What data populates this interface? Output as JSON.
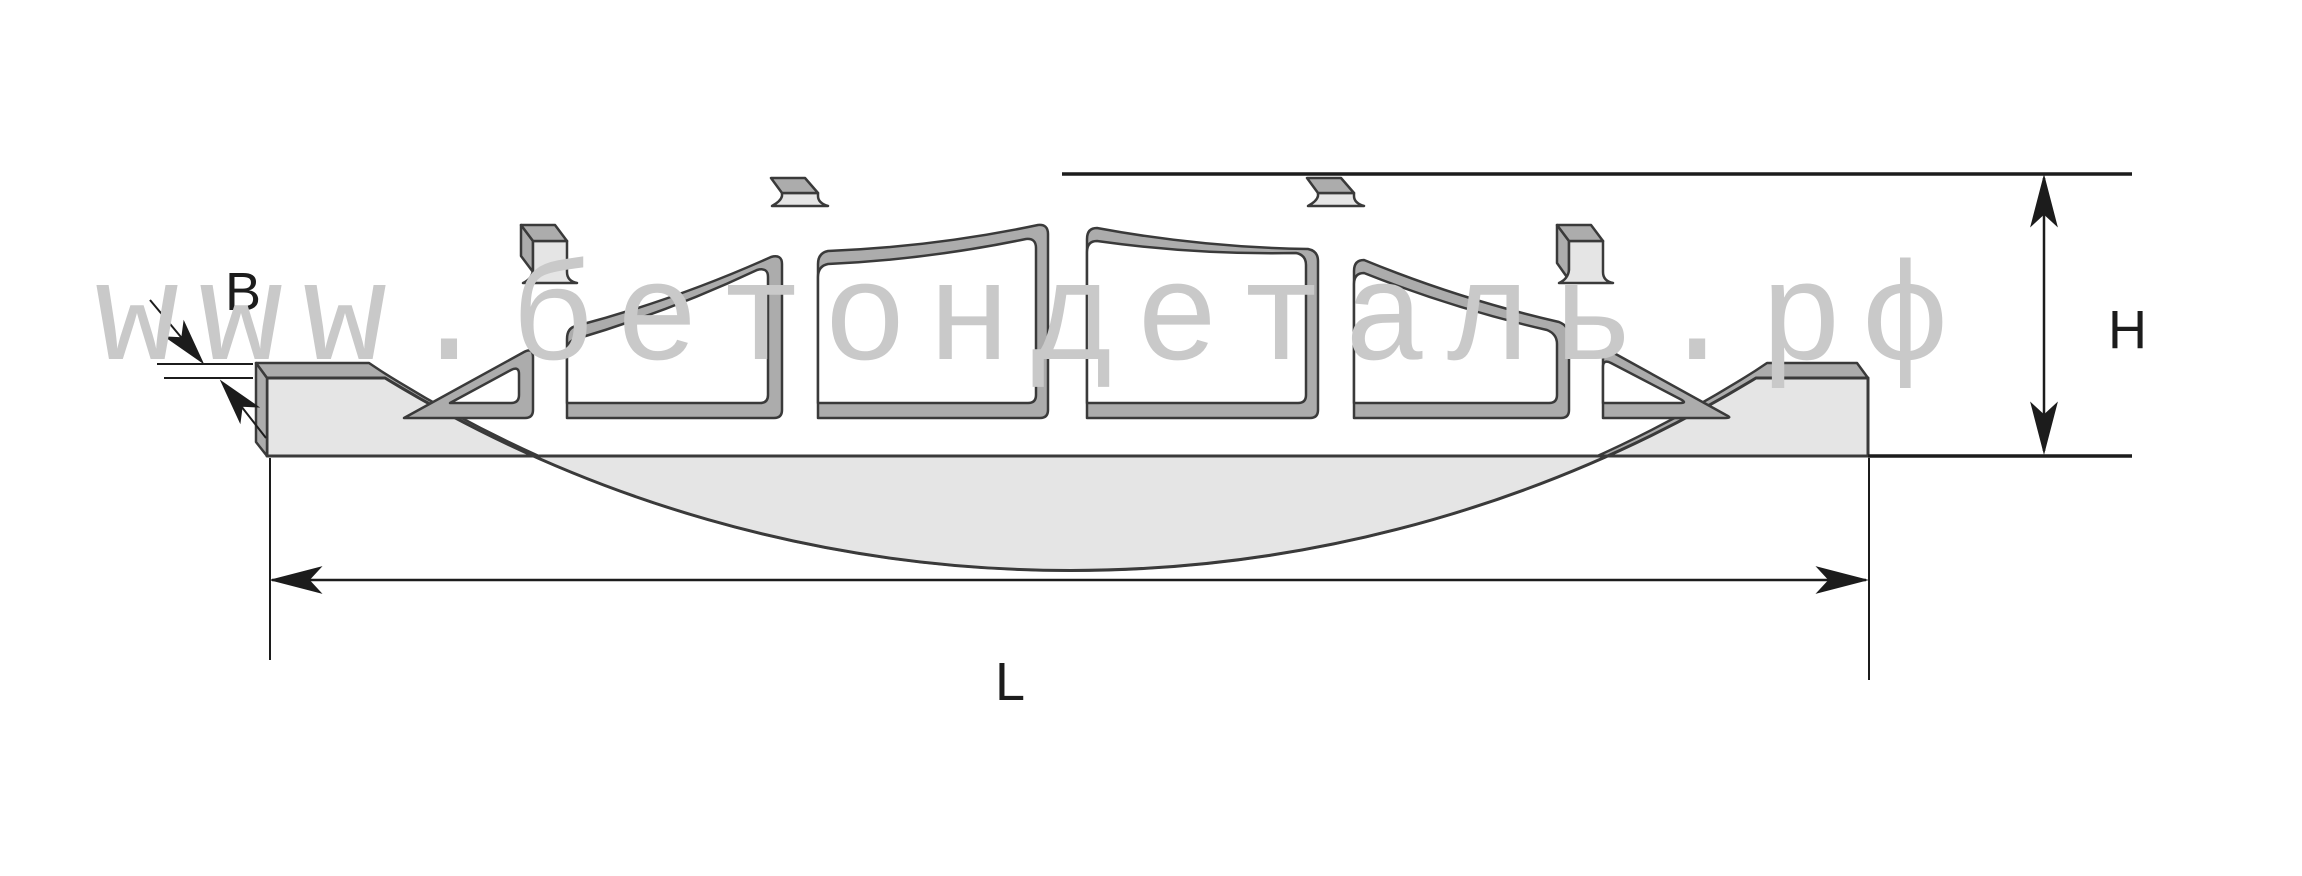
{
  "diagram": {
    "title_visible_text": "",
    "watermark": "www.бетондеталь.рф",
    "dimension_labels": {
      "thickness": "B",
      "height": "H",
      "length": "L"
    },
    "colors": {
      "background": "#ffffff",
      "front_face": "#e5e5e5",
      "top_surface_band": "#acacac",
      "outline": "#3a3a3a",
      "dimension_lines": "#1c1c1c",
      "watermark_text": "#c9c9c9"
    },
    "shape": {
      "type": "arched concrete panel, side elevation",
      "openings_count": 6,
      "posts_above_arch_count": 4
    }
  }
}
